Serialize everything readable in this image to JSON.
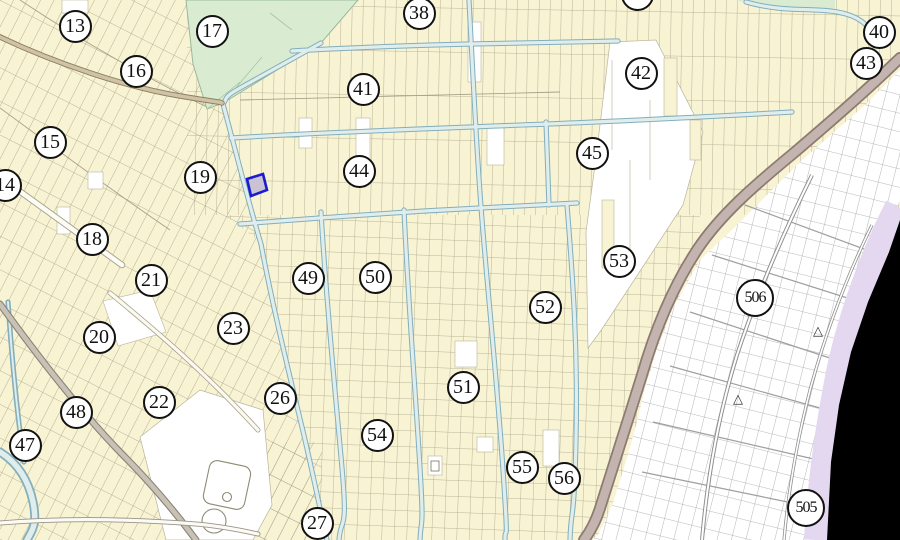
{
  "map": {
    "labels": [
      {
        "n": "13",
        "x": 75,
        "y": 26
      },
      {
        "n": "16",
        "x": 136,
        "y": 71
      },
      {
        "n": "17",
        "x": 212,
        "y": 31
      },
      {
        "n": "15",
        "x": 50,
        "y": 142
      },
      {
        "n": "14",
        "x": 5,
        "y": 185
      },
      {
        "n": "19",
        "x": 200,
        "y": 177
      },
      {
        "n": "18",
        "x": 92,
        "y": 239
      },
      {
        "n": "21",
        "x": 151,
        "y": 280
      },
      {
        "n": "20",
        "x": 99,
        "y": 337
      },
      {
        "n": "23",
        "x": 233,
        "y": 328
      },
      {
        "n": "22",
        "x": 159,
        "y": 402
      },
      {
        "n": "26",
        "x": 280,
        "y": 398
      },
      {
        "n": "48",
        "x": 76,
        "y": 412
      },
      {
        "n": "47",
        "x": 25,
        "y": 445
      },
      {
        "n": "27",
        "x": 317,
        "y": 523
      },
      {
        "n": "38",
        "x": 419,
        "y": 13
      },
      {
        "n": "39",
        "x": 637,
        "y": -6
      },
      {
        "n": "41",
        "x": 363,
        "y": 89
      },
      {
        "n": "44",
        "x": 359,
        "y": 171
      },
      {
        "n": "42",
        "x": 641,
        "y": 73
      },
      {
        "n": "45",
        "x": 592,
        "y": 153
      },
      {
        "n": "40",
        "x": 879,
        "y": 32
      },
      {
        "n": "43",
        "x": 866,
        "y": 63
      },
      {
        "n": "49",
        "x": 308,
        "y": 278
      },
      {
        "n": "50",
        "x": 375,
        "y": 277
      },
      {
        "n": "53",
        "x": 619,
        "y": 261
      },
      {
        "n": "52",
        "x": 545,
        "y": 307
      },
      {
        "n": "51",
        "x": 463,
        "y": 387
      },
      {
        "n": "54",
        "x": 377,
        "y": 435
      },
      {
        "n": "55",
        "x": 522,
        "y": 467
      },
      {
        "n": "56",
        "x": 564,
        "y": 478
      },
      {
        "n": "506",
        "x": 755,
        "y": 298,
        "r": 19
      },
      {
        "n": "505",
        "x": 806,
        "y": 508,
        "r": 19
      }
    ],
    "markers": [
      {
        "type": "triangle",
        "x": 818,
        "y": 333
      },
      {
        "type": "triangle",
        "x": 738,
        "y": 401
      }
    ],
    "glyphs": {
      "triangle": "△"
    },
    "highlighted_parcel": {
      "x": 256,
      "y": 185,
      "outline": "#1b1bd0",
      "fill": "#cac3d4"
    },
    "palette": {
      "farmland": "#f8f3d3",
      "forest": "#d9ecd2",
      "parcel_line": "#a8a189",
      "water_fill": "#dfeeec",
      "water_edge": "#84aebb",
      "road_major_fill": "#c3b4b0",
      "road_major_edge": "#8d7a70",
      "road_tan_fill": "#cfc3a4",
      "road_tan_edge": "#8d8064",
      "urban_bg": "#ffffff",
      "urban_line": "#9b9b9b",
      "coast_strip": "#e4d8f1",
      "sea": "#000000",
      "label_ink": "#111111",
      "label_bg": "#ffffff"
    }
  }
}
